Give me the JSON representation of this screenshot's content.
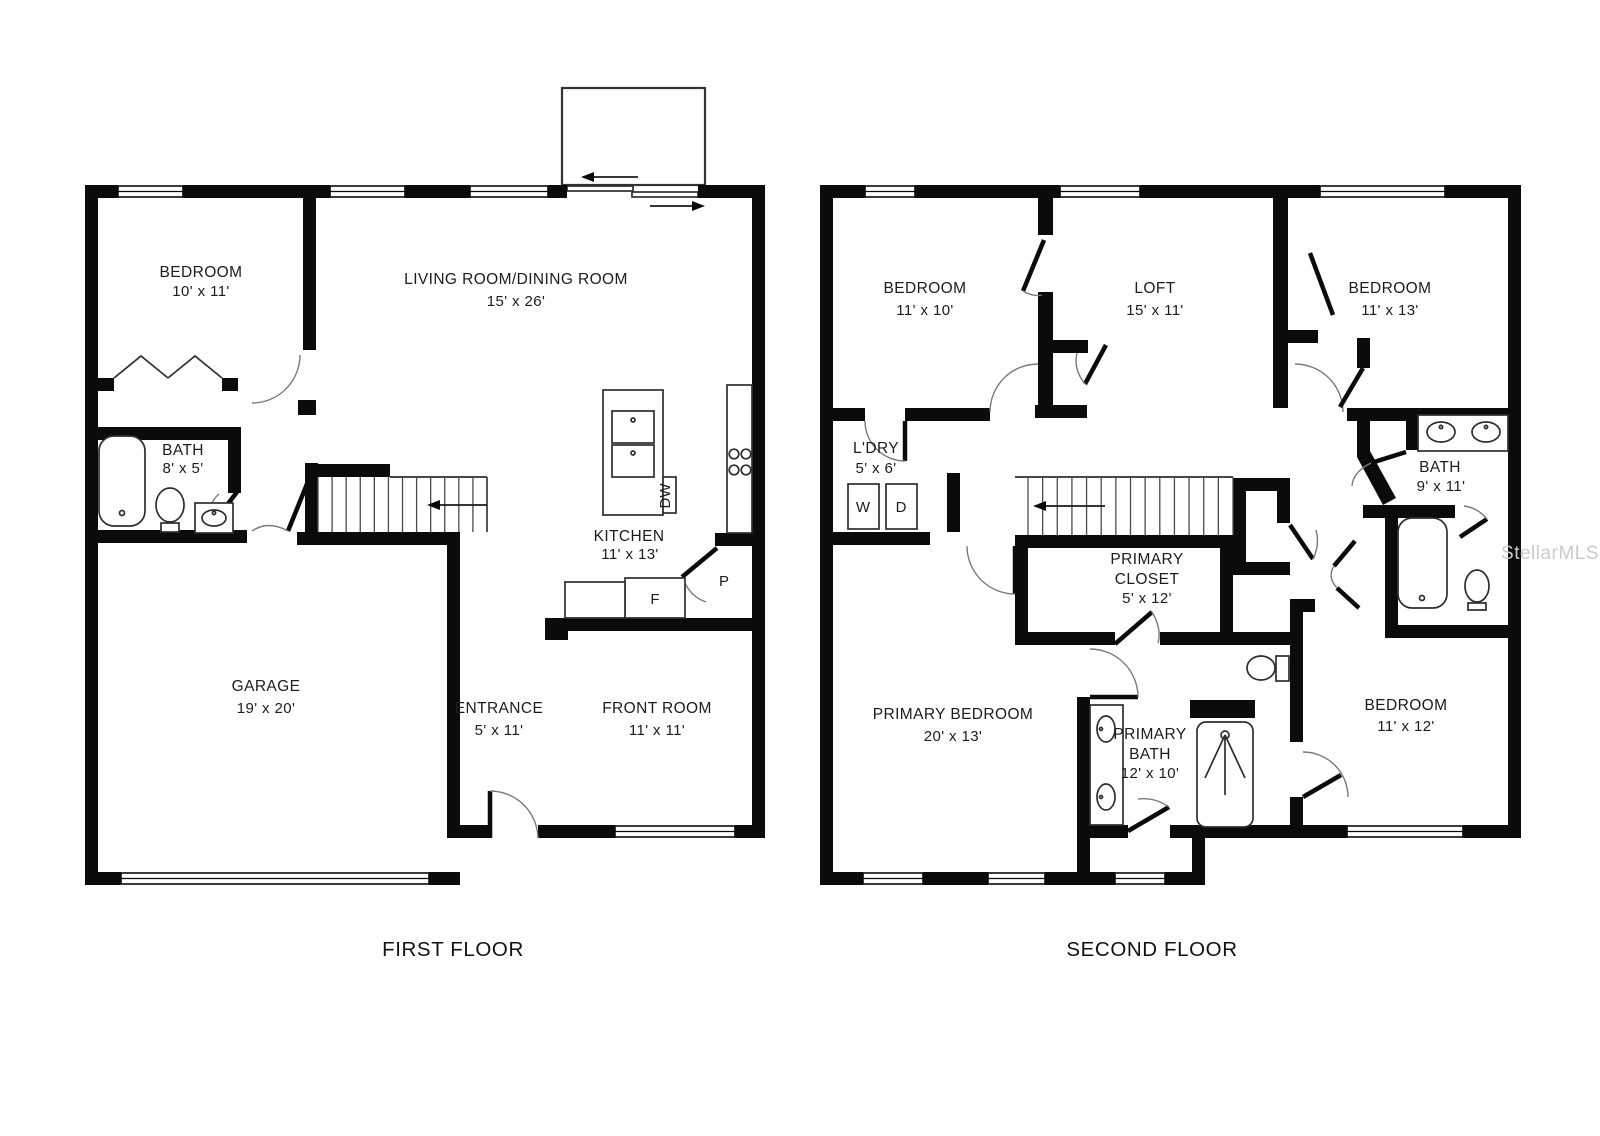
{
  "watermark": "StellarMLS",
  "floors": [
    {
      "title": "FIRST FLOOR",
      "rooms": [
        {
          "id": "bedroom",
          "lines": [
            "BEDROOM",
            "10' x 11'"
          ]
        },
        {
          "id": "living-dining",
          "lines": [
            "LIVING ROOM/DINING ROOM",
            "15' x 26'"
          ]
        },
        {
          "id": "bath",
          "lines": [
            "BATH",
            "8' x 5'"
          ]
        },
        {
          "id": "kitchen",
          "lines": [
            "KITCHEN",
            "11' x 13'"
          ]
        },
        {
          "id": "garage",
          "lines": [
            "GARAGE",
            "19' x 20'"
          ]
        },
        {
          "id": "entrance",
          "lines": [
            "ENTRANCE",
            "5' x 11'"
          ]
        },
        {
          "id": "front-room",
          "lines": [
            "FRONT ROOM",
            "11' x 11'"
          ]
        }
      ],
      "appliances": [
        {
          "id": "fridge",
          "label": "F"
        },
        {
          "id": "pantry",
          "label": "P"
        },
        {
          "id": "dishwasher",
          "label": "DW"
        }
      ]
    },
    {
      "title": "SECOND FLOOR",
      "rooms": [
        {
          "id": "bedroom-2",
          "lines": [
            "BEDROOM",
            "11' x 10'"
          ]
        },
        {
          "id": "loft",
          "lines": [
            "LOFT",
            "15' x 11'"
          ]
        },
        {
          "id": "bedroom-3",
          "lines": [
            "BEDROOM",
            "11' x 13'"
          ]
        },
        {
          "id": "laundry",
          "lines": [
            "L'DRY",
            "5' x 6'"
          ]
        },
        {
          "id": "bath-2",
          "lines": [
            "BATH",
            "9' x 11'"
          ]
        },
        {
          "id": "primary-closet",
          "lines": [
            "PRIMARY",
            "CLOSET",
            "5' x 12'"
          ]
        },
        {
          "id": "primary-bedroom",
          "lines": [
            "PRIMARY BEDROOM",
            "20' x 13'"
          ]
        },
        {
          "id": "primary-bath",
          "lines": [
            "PRIMARY",
            "BATH",
            "12' x 10'"
          ]
        },
        {
          "id": "bedroom-4",
          "lines": [
            "BEDROOM",
            "11' x 12'"
          ]
        }
      ],
      "appliances": [
        {
          "id": "washer",
          "label": "W"
        },
        {
          "id": "dryer",
          "label": "D"
        }
      ]
    }
  ]
}
